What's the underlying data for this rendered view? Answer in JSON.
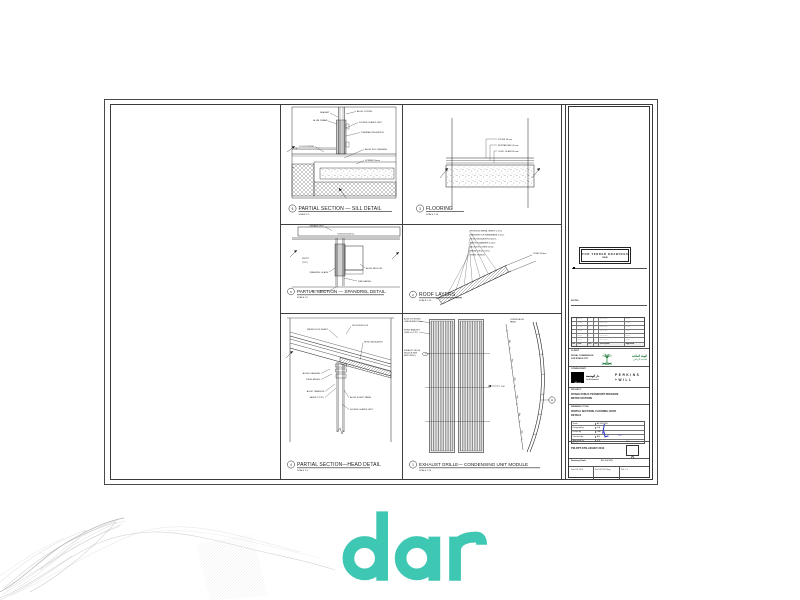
{
  "canvas": {
    "background": "#ffffff"
  },
  "footer_logo": {
    "wordmark": "dar",
    "color": "#3ec7b2"
  },
  "sheet": {
    "panels": {
      "sill": {
        "num": "6",
        "title": "PARTIAL SECTION  —  SILL DETAIL",
        "scale": "SCALE 1:5"
      },
      "flooring": {
        "num": "3",
        "title": "FLOORING",
        "scale": "SCALE 1:10"
      },
      "spandrel": {
        "num": "5",
        "title": "PARTIAL SECTION  —  SPANDREL DETAIL",
        "scale": "SCALE 1:5"
      },
      "roof": {
        "num": "2",
        "title": "ROOF LAYERS",
        "scale": "SCALE 1:10"
      },
      "head": {
        "num": "4",
        "title": "PARTIAL SECTION—HEAD DETAIL",
        "scale": "SCALE 1:5"
      },
      "exhaust": {
        "num": "1",
        "title": "EXHAUST GRILLE—  CONDENSING UNIT MODULE",
        "scale": "SCALE 1:20"
      }
    },
    "annotations": {
      "sill": [
        "SEALANT",
        "ALUM. FRAME",
        "ALUM. COPING",
        "DOUBLE GLAZED UNIT",
        "THERMAL INSULATION",
        "ALUM. SILL FLASHING",
        "FLOOR FINISH",
        "SCREED 50mm"
      ],
      "sill_marks": {
        "grid_a": "8",
        "grid_b": "5"
      },
      "flooring": [
        "STONE 30 mm",
        "MORTAR BED 30 mm",
        "CONC. SLAB 200 mm"
      ],
      "spandrel": {
        "band": "10X150X1200mm.",
        "frit_tag": "CERAMIC FRIT",
        "frit": "M FRIT",
        "frit_typ": "(TYP.)",
        "labels": [
          "SPANDREL GLASS",
          "ALUM. MULLION",
          "FIRE SAFING",
          "ALUM. TRANSOM"
        ]
      },
      "roof": [
        "PROFILED METAL SHEET 0.7mm",
        "WATERPROOF MEMBRANE 1.5mm",
        "RIGID INSULATION 100mm",
        "VAPOUR BARRIER 0.2mm",
        "ACOUSTIC LINER 25mm",
        "METAL DECK 0.9mm",
        "STEEL PURLIN",
        "CURB 150mm"
      ],
      "head": [
        "METAL ROOF SHEET",
        "ROOF BUILD-UP",
        "RIGID INSULATION",
        "ALUM. FLASHING",
        "STEEL ANGLE",
        "ALUM. TRANSOM",
        "GASKET (TYP.)",
        "ALUM. SOFFIT PANEL",
        "DOUBLE GLAZED UNIT"
      ],
      "exhaust": {
        "left": [
          "ALUM. EXTRUDED",
          "OVAL BLADES 50mm",
          "FIXING BRACKET",
          "@600 c/c (TYP.)",
          "EXHAUST GRILLE",
          "MODULE (SEE",
          "MEP DWGS.)"
        ],
        "dim": "150",
        "right_label1": "CURVED ALUM.",
        "right_label2": "PANEL",
        "curve_dims": [
          "300",
          "300",
          "300",
          "600",
          "300",
          "300"
        ],
        "tag": "A"
      }
    }
  },
  "titleblock": {
    "stamp": {
      "line1": "FOR TENDER DRAWINGS",
      "line2": "ISSUE"
    },
    "notes_label": "NOTES",
    "rev_table": {
      "header": [
        "No.",
        "Date",
        "Drn",
        "Chk",
        "Description",
        "Approved"
      ],
      "rows": [
        [
          "-",
          "--.--.--",
          "--",
          "--",
          "---- --- ----",
          "--- ---"
        ],
        [
          "-",
          "--.--.--",
          "--",
          "--",
          "---- --- ----",
          "--- ---"
        ],
        [
          "-",
          "--.--.--",
          "--",
          "--",
          "---- --- ----",
          "--- ---"
        ],
        [
          "-",
          "--.--.--",
          "--",
          "--",
          "---- --- ----",
          "--- ---"
        ],
        [
          "-",
          "--.--.--",
          "--",
          "--",
          "---- --- ----",
          "--- ---"
        ],
        [
          "-",
          "--.--.--",
          "--",
          "--",
          "---- --- ----",
          "--- ---"
        ]
      ]
    },
    "client": {
      "label": "CLIENT",
      "name1": "ROYAL COMMISSION",
      "name2": "FOR RIYADH CITY",
      "ar1": "الهيئة الملكية",
      "ar2": "لمدينة الرياض"
    },
    "consultant": {
      "label": "CONSULTANT",
      "dar_mark": "dar",
      "dar_sub1": "دار الهندسة",
      "dar_sub2": "Dar Al-Handasah",
      "pw1": "PERKINS",
      "pw2": "+WILL"
    },
    "project": {
      "label": "PROJECT",
      "line1": "RIYADH PUBLIC TRANSPORT PROGRAM",
      "line2": "METRO STATIONS"
    },
    "drawing_title": {
      "label": "DRAWING TITLE",
      "line1": "PARTIAL SECTIONS, FLOORING, ROOF",
      "line2": "DETAILS"
    },
    "fields": [
      {
        "label": "Scale",
        "value": "AS SHOWN"
      },
      {
        "label": "Designed by",
        "value": "D.A."
      },
      {
        "label": "Drawn by",
        "value": "CAD"
      },
      {
        "label": "Checked by",
        "value": "A.B."
      },
      {
        "label": "Approved by",
        "value": "H.S."
      }
    ],
    "blue_note": "100",
    "dwg": {
      "label": "DWG. No.",
      "number": "PW-RPT-STN-AR-DET-2012",
      "rev_label": "REV.",
      "rev": "0"
    },
    "scale_row": {
      "label": "Drawing Scale",
      "value": "AS SHOWN"
    },
    "bottom_row": [
      {
        "label": "Date",
        "value": "JUL 2016"
      },
      {
        "label": "File",
        "value": "DET-2012.dwg"
      },
      {
        "label": "Plot",
        "value": "1 : 1"
      }
    ]
  }
}
